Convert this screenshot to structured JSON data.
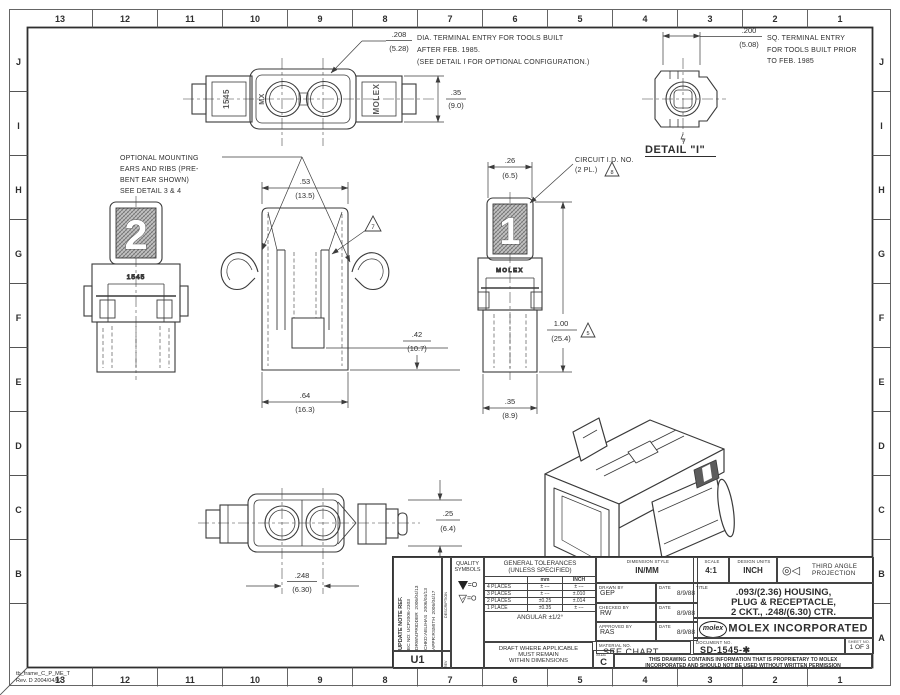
{
  "frame": {
    "file": "tb_frame_C_P_ME_T",
    "rev": "Rev. D 2004/04/02",
    "cols": [
      "13",
      "12",
      "11",
      "10",
      "9",
      "8",
      "7",
      "6",
      "5",
      "4",
      "3",
      "2",
      "1"
    ],
    "rows": [
      "J",
      "I",
      "H",
      "G",
      "F",
      "E",
      "D",
      "C",
      "B",
      "A"
    ]
  },
  "notes": {
    "dia": {
      "inch": ".208",
      "mm": "(5.28)",
      "l1": "DIA. TERMINAL ENTRY FOR TOOLS BUILT",
      "l2": "AFTER FEB. 1985.",
      "l3": "(SEE DETAIL I FOR OPTIONAL CONFIGURATION.)"
    },
    "sq": {
      "inch": ".200",
      "mm": "(5.08)",
      "l1": "SQ. TERMINAL ENTRY",
      "l2": "FOR TOOLS BUILT PRIOR",
      "l3": "TO FEB. 1985"
    },
    "detail_label": "DETAIL \"I\"",
    "mount": {
      "l1": "OPTIONAL MOUNTING",
      "l2": "EARS AND RIBS (PRE-",
      "l3": "BENT EAR SHOWN)",
      "l4": "SEE DETAIL 3 & 4"
    },
    "circuit": {
      "l1": "CIRCUIT I.D. NO.",
      "l2": "(2 PL.)"
    }
  },
  "dims": {
    "h35": {
      "inch": ".35",
      "mm": "(9.0)"
    },
    "w53": {
      "inch": ".53",
      "mm": "(13.5)"
    },
    "w26": {
      "inch": ".26",
      "mm": "(6.5)"
    },
    "h42": {
      "inch": ".42",
      "mm": "(10.7)"
    },
    "w64": {
      "inch": ".64",
      "mm": "(16.3)"
    },
    "h100": {
      "inch": "1.00",
      "mm": "(25.4)"
    },
    "w35": {
      "inch": ".35",
      "mm": "(8.9)"
    },
    "h25": {
      "inch": ".25",
      "mm": "(6.4)"
    },
    "w248": {
      "inch": ".248",
      "mm": "(6.30)"
    }
  },
  "flags": {
    "slot": "7",
    "circuit": "8",
    "height": "5"
  },
  "views": {
    "top": {
      "left_label": "1545",
      "mx": "MX",
      "right_label": "MOLEX"
    },
    "left": {
      "num": "2",
      "label": "1545"
    },
    "right": {
      "num": "1",
      "label": "MOLEX"
    }
  },
  "titleblock": {
    "update": {
      "l1": "UPDATE NOTE REF.",
      "l2": "EC NO: UCP2006-2303",
      "l3": "DRWN:PRIDDER  2006/04/13",
      "l4": "CHKD:AELIHAS  2006/04/13",
      "l5": "APPR:RSMITH  2006/04/17",
      "description": "DESCRIPTION",
      "rev_label": "REV",
      "rev": "U1"
    },
    "quality": {
      "l1": "QUALITY",
      "l2": "SYMBOLS",
      "eq1": "=O",
      "eq2": "=O"
    },
    "tol": {
      "t1": "GENERAL TOLERANCES",
      "t2": "(UNLESS SPECIFIED)",
      "mm": "mm",
      "inch": "INCH",
      "r1": [
        "4 PLACES",
        "± ---",
        "± ---"
      ],
      "r2": [
        "3 PLACES",
        "± ---",
        "±.010"
      ],
      "r3": [
        "2 PLACES",
        "±0.25",
        "±.014"
      ],
      "r4": [
        "1 PLACE",
        "±0.35",
        "± ---"
      ],
      "angular": "ANGULAR ±1/2°"
    },
    "draft": {
      "l1": "DRAFT WHERE APPLICABLE",
      "l2": "MUST REMAIN",
      "l3": "WITHIN DIMENSIONS"
    },
    "dimstyle": {
      "label": "DIMENSION STYLE",
      "value": "IN/MM"
    },
    "drawn": {
      "label": "DRAWN BY",
      "value": "GEP",
      "date_label": "DATE",
      "date": "8/9/88"
    },
    "checked": {
      "label": "CHECKED BY",
      "value": "RW",
      "date_label": "DATE",
      "date": "8/9/88"
    },
    "approved": {
      "label": "APPROVED BY",
      "value": "RAS",
      "date_label": "DATE",
      "date": "8/9/88"
    },
    "material": {
      "label": "MATERIAL NO.",
      "value": "SEE CHART"
    },
    "size": {
      "label": "SIZE",
      "value": "C"
    },
    "scale": {
      "label": "SCALE",
      "value": "4:1"
    },
    "units": {
      "label": "DESIGN UNITS",
      "value": "INCH"
    },
    "projection": {
      "l1": "THIRD ANGLE",
      "l2": "PROJECTION"
    },
    "title": {
      "l1": ".093/(2.36) HOUSING,",
      "l2": "PLUG & RECEPTACLE,",
      "l3": "2 CKT., .248/(6.30) CTR."
    },
    "company": {
      "logo": "molex",
      "name": "MOLEX INCORPORATED"
    },
    "doc": {
      "label": "DOCUMENT NO.",
      "value": "SD-1545-✱"
    },
    "sheet": {
      "label": "SHEET NO.",
      "value": "1 OF 3"
    },
    "proprietary": {
      "l1": "THIS DRAWING CONTAINS INFORMATION THAT IS PROPRIETARY TO MOLEX",
      "l2": "INCORPORATED AND SHOULD NOT BE USED WITHOUT WRITTEN PERMISSION"
    }
  }
}
